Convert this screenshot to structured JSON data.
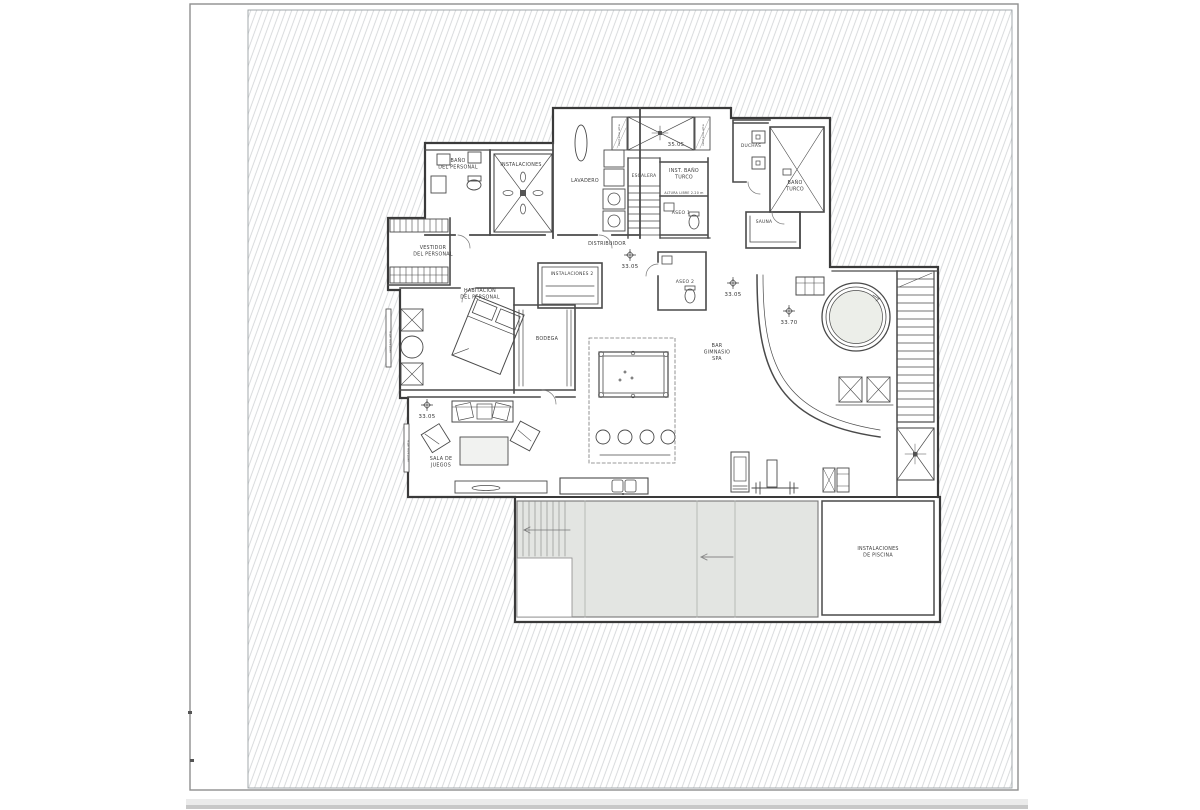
{
  "page": {
    "background": "#ffffff",
    "sheet_border_color": "#8f8f8f",
    "hatch_line_color": "#cfd2d4",
    "plan_line_color": "#434343",
    "pool_fill": "#e3e5e2",
    "bottom_bar_color": "#ebebeb"
  },
  "plan": {
    "drawing_type": "basement-floor-plan",
    "labels": [
      {
        "id": "bano-personal",
        "lines": [
          "BAÑO",
          "DEL PERSONAL"
        ],
        "x": 458,
        "y": 162,
        "fs": 4.8
      },
      {
        "id": "instalaciones",
        "lines": [
          "INSTALACIONES"
        ],
        "x": 521,
        "y": 166,
        "fs": 4.8
      },
      {
        "id": "lavadero",
        "lines": [
          "LAVADERO"
        ],
        "x": 585,
        "y": 182,
        "fs": 4.8
      },
      {
        "id": "escalera",
        "lines": [
          "ESCALERA"
        ],
        "x": 644,
        "y": 177,
        "fs": 4.4
      },
      {
        "id": "nivel-35-05",
        "lines": [
          "35.05"
        ],
        "x": 676,
        "y": 146,
        "fs": 5.4
      },
      {
        "id": "inst-bano-turco",
        "lines": [
          "INST. BAÑO",
          "TURCO"
        ],
        "x": 684,
        "y": 172,
        "fs": 4.8
      },
      {
        "id": "altura-libre",
        "lines": [
          "ALTURA LIBRE 2.20 m"
        ],
        "x": 684,
        "y": 194,
        "fs": 3.2
      },
      {
        "id": "aseo-1",
        "lines": [
          "ASEO 1"
        ],
        "x": 681,
        "y": 214,
        "fs": 4.6
      },
      {
        "id": "duchas",
        "lines": [
          "DUCHAS"
        ],
        "x": 751,
        "y": 147,
        "fs": 4.4
      },
      {
        "id": "bano-turco",
        "lines": [
          "BAÑO",
          "TURCO"
        ],
        "x": 795,
        "y": 184,
        "fs": 4.8
      },
      {
        "id": "sauna",
        "lines": [
          "SAUNA"
        ],
        "x": 764,
        "y": 223,
        "fs": 4.4
      },
      {
        "id": "distribuidor",
        "lines": [
          "DISTRIBUIDOR"
        ],
        "x": 607,
        "y": 245,
        "fs": 4.8
      },
      {
        "id": "aseo-2",
        "lines": [
          "ASEO 2"
        ],
        "x": 685,
        "y": 283,
        "fs": 4.6
      },
      {
        "id": "vestidor",
        "lines": [
          "VESTIDOR",
          "DEL PERSONAL"
        ],
        "x": 433,
        "y": 249,
        "fs": 4.8
      },
      {
        "id": "habitacion",
        "lines": [
          "HABITACIÓN",
          "DEL PERSONAL"
        ],
        "x": 480,
        "y": 292,
        "fs": 4.8
      },
      {
        "id": "instalaciones-2",
        "lines": [
          "INSTALACIONES 2"
        ],
        "x": 572,
        "y": 275,
        "fs": 4.4
      },
      {
        "id": "bodega",
        "lines": [
          "BODEGA"
        ],
        "x": 547,
        "y": 340,
        "fs": 4.8
      },
      {
        "id": "bar-gimnasio-spa",
        "lines": [
          "BAR",
          "GIMNASIO",
          "SPA"
        ],
        "x": 717,
        "y": 347,
        "fs": 4.8
      },
      {
        "id": "sala-de-juegos",
        "lines": [
          "SALA DE",
          "JUEGOS"
        ],
        "x": 441,
        "y": 460,
        "fs": 4.8
      },
      {
        "id": "instalaciones-piscina",
        "lines": [
          "INSTALACIONES",
          "DE PISCINA"
        ],
        "x": 878,
        "y": 550,
        "fs": 4.8
      },
      {
        "id": "ventana-alta-1",
        "lines": [
          "ventana alta"
        ],
        "x": 391,
        "y": 342,
        "fs": 3.0,
        "rot": -90
      },
      {
        "id": "ventana-alta-2",
        "lines": [
          "ventana alta"
        ],
        "x": 409,
        "y": 451,
        "fs": 3.0,
        "rot": -90
      },
      {
        "id": "ventana-alta-3",
        "lines": [
          "ventana alta"
        ],
        "x": 620,
        "y": 135,
        "fs": 3.0,
        "rot": -90
      },
      {
        "id": "ventana-alta-4",
        "lines": [
          "ventana alta"
        ],
        "x": 704,
        "y": 135,
        "fs": 3.0,
        "rot": -90
      }
    ],
    "level_markers": [
      {
        "value": "33.05",
        "x": 630,
        "y": 255
      },
      {
        "value": "33.05",
        "x": 733,
        "y": 283
      },
      {
        "value": "33.70",
        "x": 789,
        "y": 311
      },
      {
        "value": "33.05",
        "x": 427,
        "y": 405
      }
    ]
  }
}
